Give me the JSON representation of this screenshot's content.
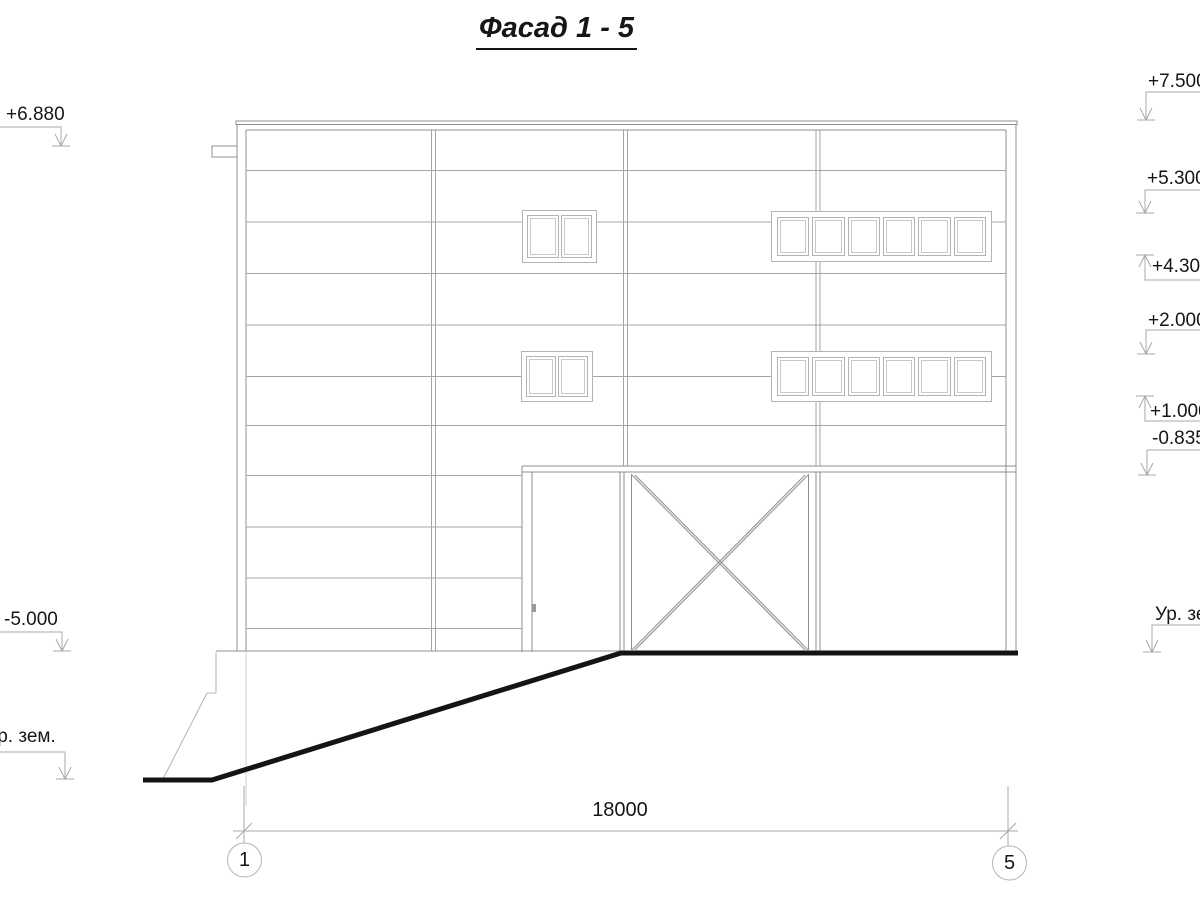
{
  "title": "Фасад 1 - 5",
  "markers": {
    "left": [
      {
        "label": "+6.880"
      },
      {
        "label": "-5.000"
      },
      {
        "label": "Ур. зем."
      }
    ],
    "right": [
      {
        "label": "+7.500"
      },
      {
        "label": "+5.300"
      },
      {
        "label": "+4.300"
      },
      {
        "label": "+2.000"
      },
      {
        "label": "+1.000"
      },
      {
        "label": "-0.835"
      },
      {
        "label": "Ур. зем."
      }
    ]
  },
  "dimension": {
    "length": "18000",
    "axis_left": "1",
    "axis_right": "5"
  },
  "colors": {
    "line": "#999999",
    "window_frame": "#b3b3b3",
    "ground": "#141414",
    "text": "#161616"
  }
}
